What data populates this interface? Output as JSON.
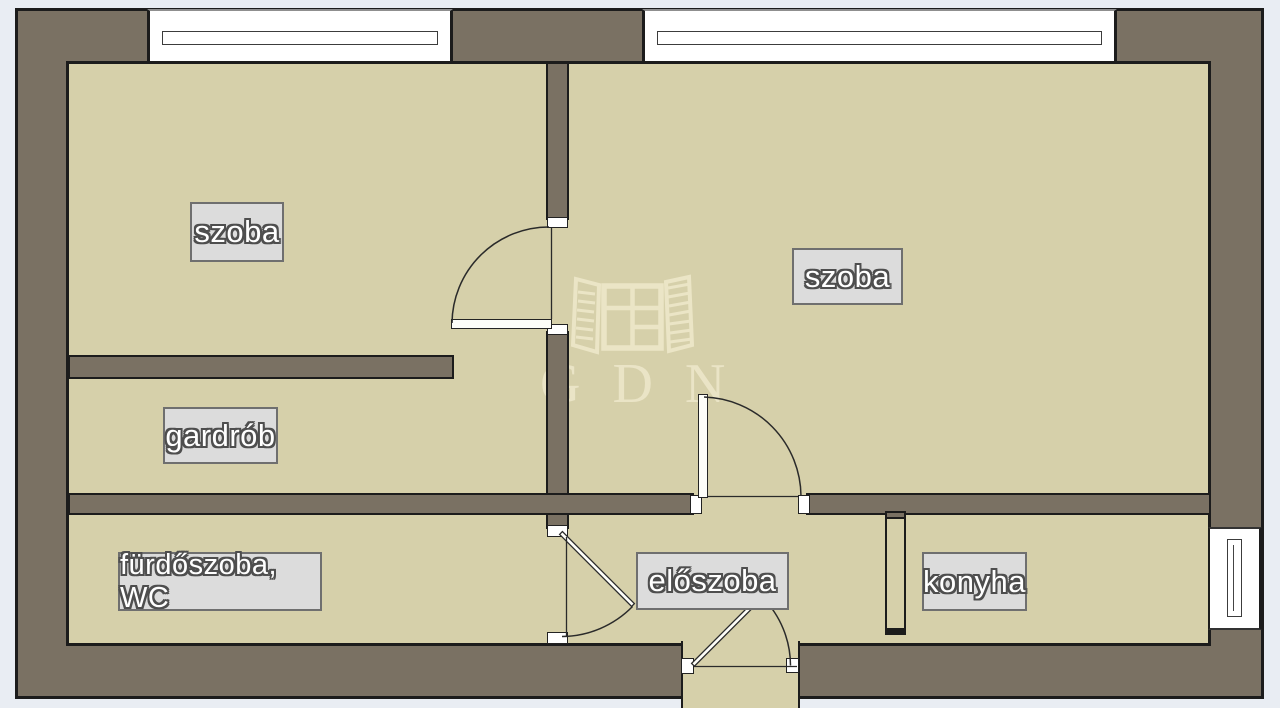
{
  "floorplan": {
    "rooms": [
      {
        "id": "szoba-1",
        "label": "szoba"
      },
      {
        "id": "szoba-2",
        "label": "szoba"
      },
      {
        "id": "gardrob",
        "label": "gardrób"
      },
      {
        "id": "furdoszoba-wc",
        "label": "fürdőszoba, WC"
      },
      {
        "id": "eloszoba",
        "label": "előszoba"
      },
      {
        "id": "konyha",
        "label": "konyha"
      }
    ],
    "watermark": {
      "text": "GDN",
      "icon": "open-window-logo"
    },
    "symbols": {
      "windows": 3,
      "door_arcs": 4
    },
    "colors": {
      "background": "#e9edf3",
      "wall_fill": "#7a7163",
      "outline": "#1c1c1c",
      "room_fill": "#d6d0aa",
      "window_fill": "#ffffff",
      "label_bg": "#dcdcdc",
      "label_border": "#6f6f6f",
      "label_text": "#ffffff",
      "label_text_outline": "#4e4e4e",
      "watermark": "#eae4c6"
    }
  }
}
